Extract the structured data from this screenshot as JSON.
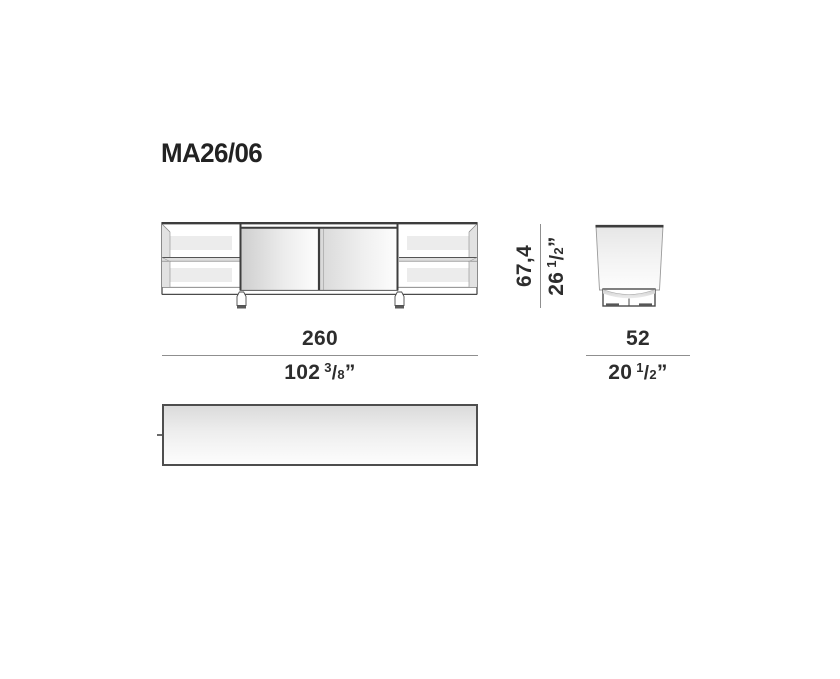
{
  "title": "MA26/06",
  "colors": {
    "outline": "#4a4a4a",
    "heavy_line": "#3d3d3d",
    "dimension_line": "#8f8f8f",
    "text": "#2d2d2d",
    "shadow_fill": "#e2e2e2"
  },
  "dimensions": {
    "width": {
      "cm": "260",
      "in_whole": "102",
      "in_num": "3",
      "in_sep": "/",
      "in_den": "8",
      "in_mark": "”"
    },
    "height": {
      "cm": "67,4",
      "in_whole": "26",
      "in_num": "1",
      "in_sep": "/",
      "in_den": "2",
      "in_mark": "”"
    },
    "depth": {
      "cm": "52",
      "in_whole": "20",
      "in_num": "1",
      "in_sep": "/",
      "in_den": "2",
      "in_mark": "”"
    }
  }
}
